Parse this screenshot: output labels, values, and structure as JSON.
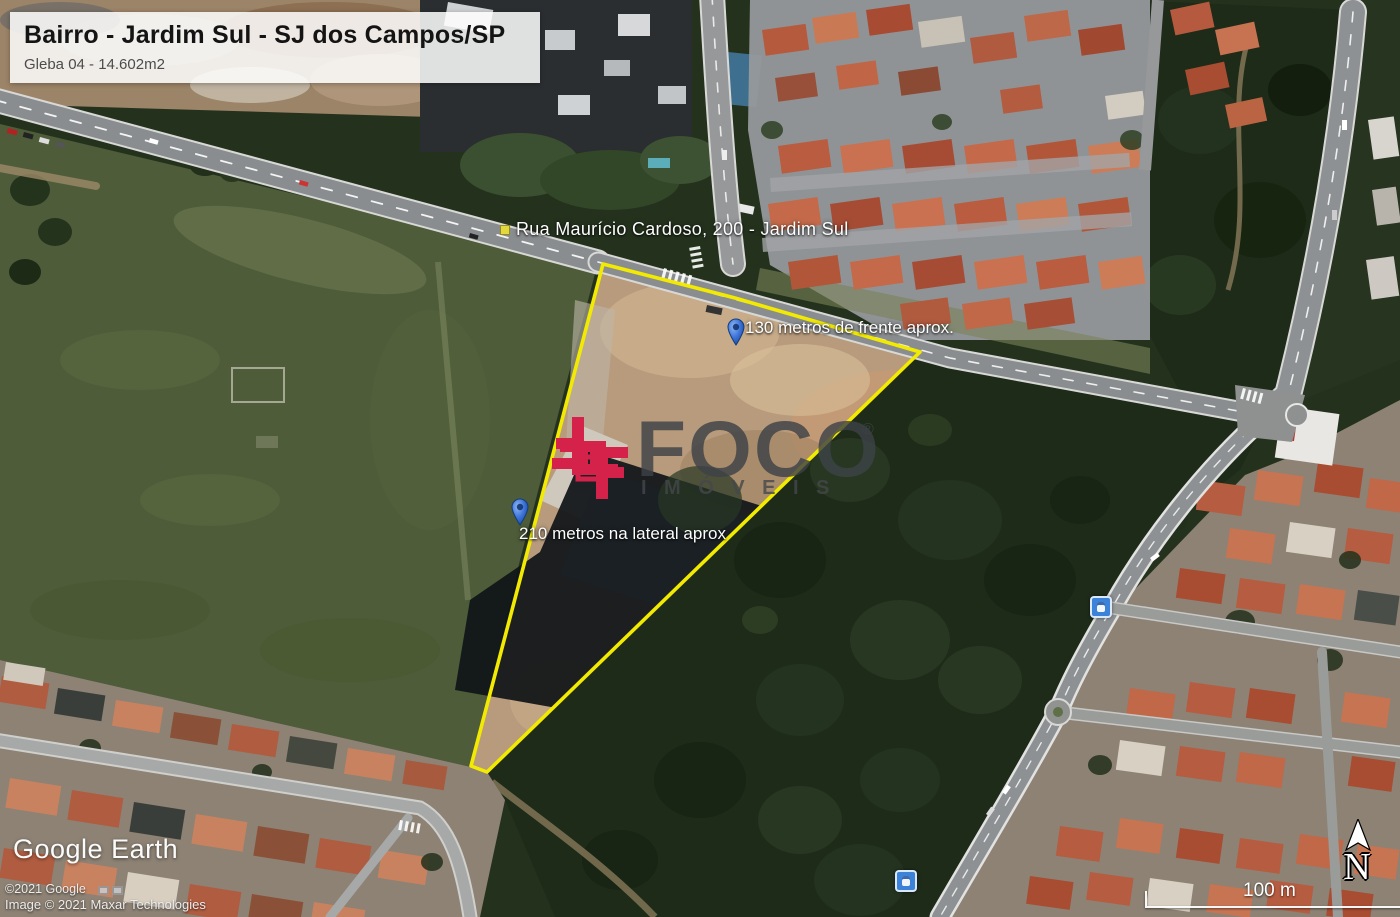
{
  "info_box": {
    "title": "Bairro - Jardim Sul - SJ dos Campos/SP",
    "subtitle": "Gleba 04 - 14.602m2"
  },
  "street_label": {
    "text": "Rua Maurício Cardoso, 200 - Jardim Sul"
  },
  "pins": [
    {
      "label": "130 metros de frente aprox."
    },
    {
      "label": "210 metros na lateral aprox"
    }
  ],
  "watermark": {
    "brand": "FOCO",
    "registered": "®",
    "subtitle": "IMÓVEIS",
    "logo_color": "#d5224a",
    "text_color": "#3e4347"
  },
  "credits": {
    "brand": "Google Earth",
    "copyright": "©2021 Google",
    "imagery": "Image © 2021 Maxar Technologies"
  },
  "scale_bar": {
    "label": "100 m"
  },
  "compass": {
    "label": "N"
  },
  "map": {
    "parcel_outline_color": "#f2ea00",
    "pin_color": "#2f6fe0",
    "transit_icon_color": "#3b82d8",
    "imagery_type": "satellite"
  }
}
